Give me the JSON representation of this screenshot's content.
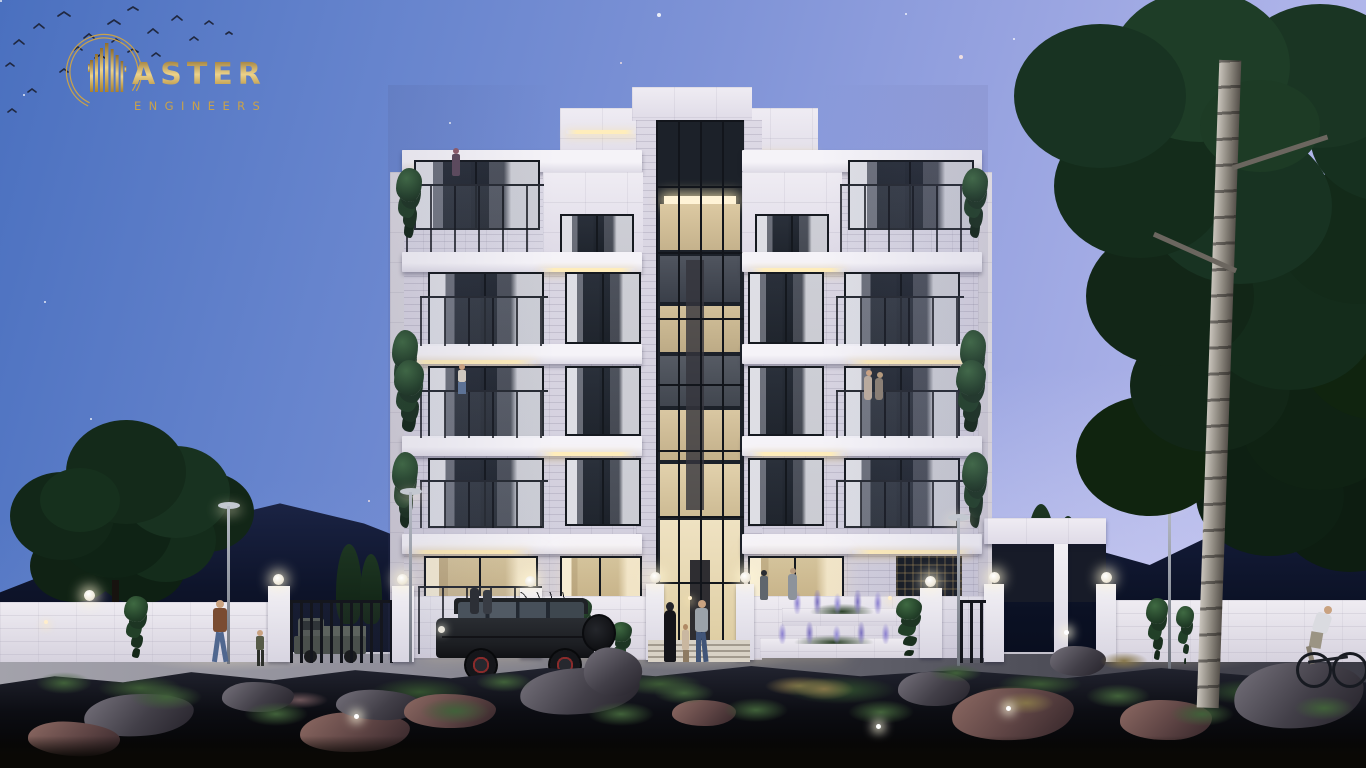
{
  "brand": {
    "name": "MASTER",
    "mark": "skyline-m-in-arc",
    "suffix": "ASTER",
    "subtitle": "ENGINEERS",
    "gold": "#c9a24a"
  },
  "scene": {
    "palette": {
      "sky_top_left": "#4a70bf",
      "sky_bottom_right": "#bcc0ee",
      "mountains": "#0c1228",
      "facade_white": "#eae7f0",
      "warm_light": "#ffedbb",
      "window_glass": "#20252e",
      "foliage": "#1c3a24",
      "ground": "#07070c",
      "rock_grey": "#6e6a74",
      "rock_red": "#8a6660"
    }
  }
}
